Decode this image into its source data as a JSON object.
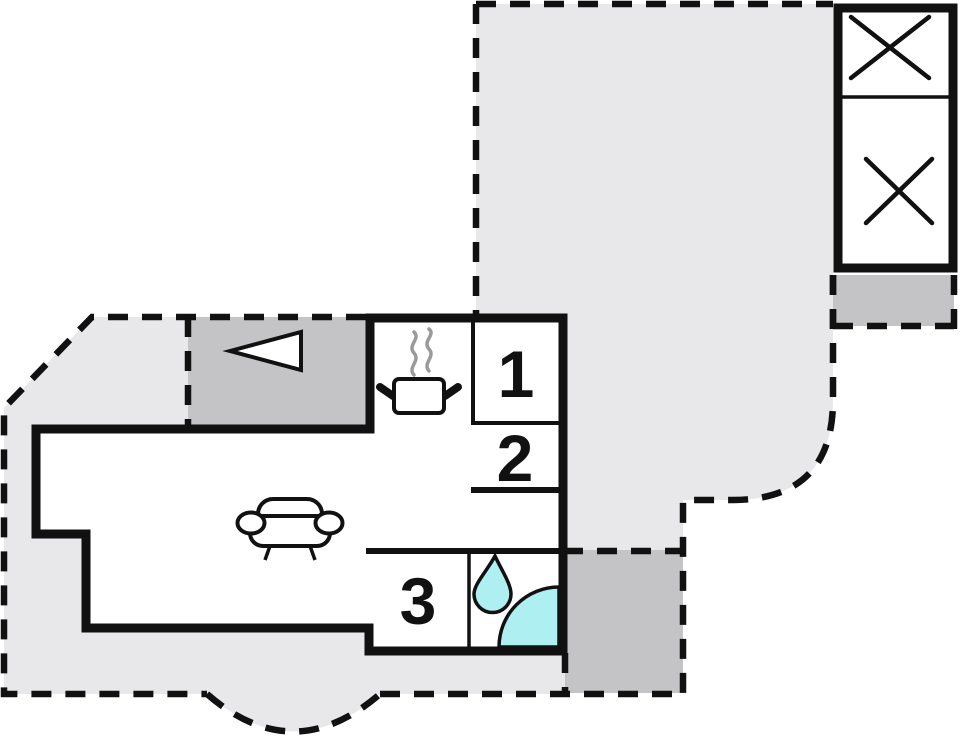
{
  "plan": {
    "name": "holiday-home-floor-plan",
    "rooms": [
      {
        "id": "room-1",
        "label": "1"
      },
      {
        "id": "room-2",
        "label": "2"
      },
      {
        "id": "room-3",
        "label": "3"
      }
    ],
    "colors": {
      "background": "#ffffff",
      "terrace": "#e8e8eb",
      "balcony": "#c4c4c7",
      "wall": "#111111",
      "water": "#aeeff2",
      "steam": "#9a9a9a",
      "room_fill": "#ffffff"
    },
    "icons": [
      "tv-icon",
      "cooker-icon",
      "sofa-icon",
      "water-drop-icon",
      "shower-icon",
      "crossed-square-icon",
      "crossed-square-icon"
    ]
  }
}
